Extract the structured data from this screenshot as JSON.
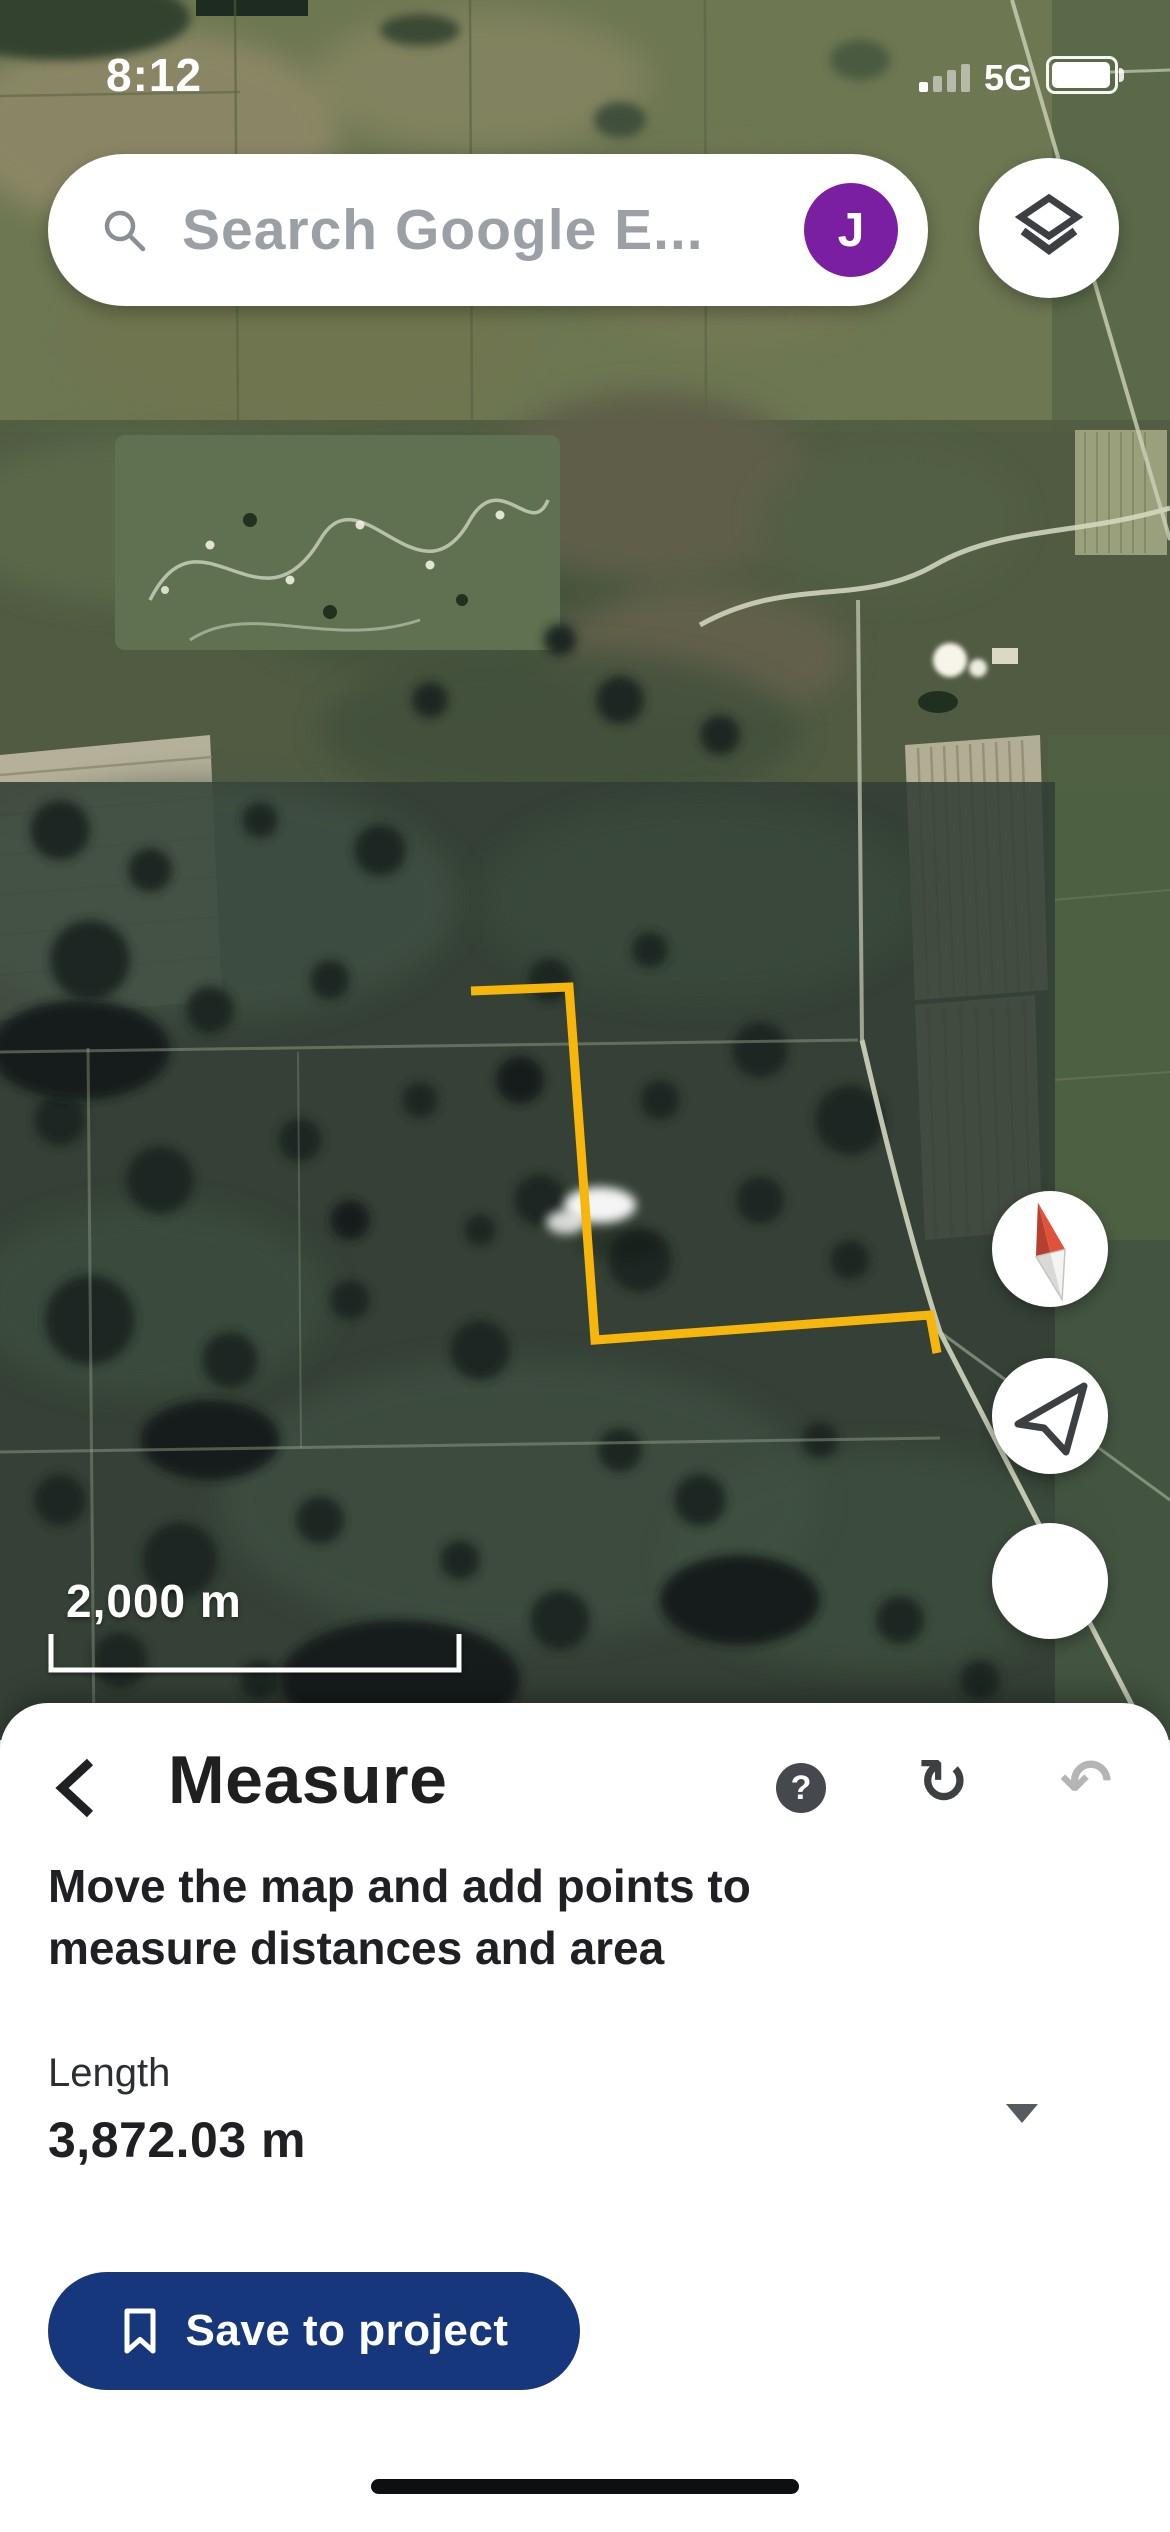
{
  "status_bar": {
    "time": "8:12",
    "network_label": "5G",
    "signal_bars_total": 4,
    "signal_bars_filled": 1,
    "battery_fill_ratio": 0.88
  },
  "search_bar": {
    "placeholder": "Search Google E...",
    "avatar_initial": "J",
    "icons": [
      "search-icon",
      "account-avatar"
    ]
  },
  "map": {
    "scale_bar_label": "2,000 m",
    "measure_line": {
      "color": "#F6B60C",
      "points_px": [
        [
          471,
          991
        ],
        [
          569,
          987
        ],
        [
          595,
          1340
        ],
        [
          930,
          1315
        ],
        [
          937,
          1353
        ]
      ]
    },
    "controls": [
      "layers-icon",
      "compass-icon",
      "my-location-icon",
      "blank-circle-button"
    ]
  },
  "sheet": {
    "title": "Measure",
    "header_icons": {
      "back": "chevron-left-icon",
      "help_glyph": "?",
      "redo_glyph": "↻",
      "undo_glyph": "↶"
    },
    "instruction": "Move the map and add points to measure distances and area",
    "length_label": "Length",
    "length_value": "3,872.03 m",
    "unit_dropdown_icon": "chevron-down-icon",
    "save_button_label": "Save to project",
    "save_button_icon": "bookmark-icon"
  },
  "colors": {
    "save_button_bg": "#17377D",
    "avatar_bg": "#7B1FA2",
    "help_icon_bg": "#45484C",
    "measure_line": "#F6B60C"
  }
}
